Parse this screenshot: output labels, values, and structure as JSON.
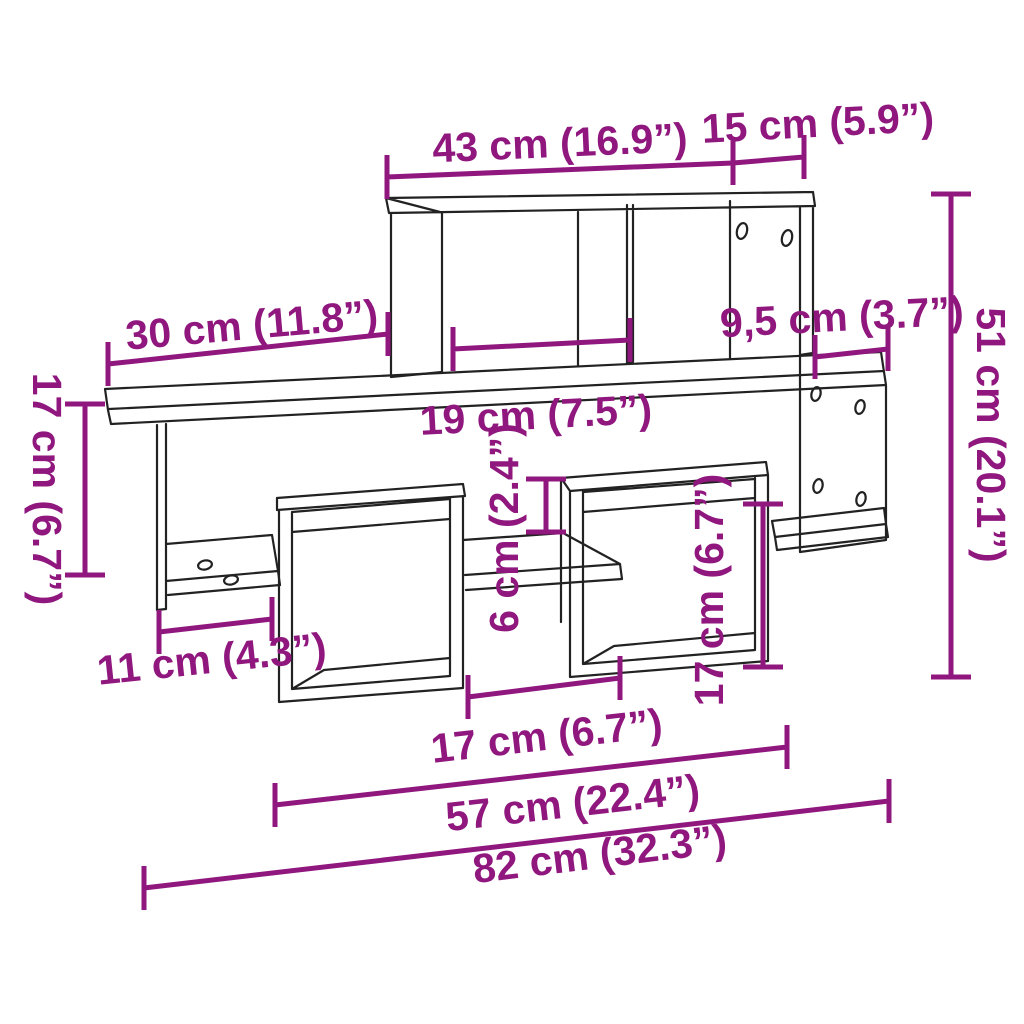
{
  "colors": {
    "dimension": "#8F177E",
    "line_art": "#222222",
    "background": "#FFFFFF"
  },
  "dimensions": {
    "top_width": {
      "label": "43 cm (16.9”)"
    },
    "top_depth": {
      "label": "15 cm (5.9”)"
    },
    "left_shelf_width": {
      "label": "30 cm (11.8”)"
    },
    "compartment_width": {
      "label": "19 cm (7.5”)"
    },
    "right_overhang": {
      "label": "9,5 cm (3.7”)"
    },
    "total_height": {
      "label": "51 cm (20.1”)"
    },
    "left_height": {
      "label": "17 cm (6.7”)"
    },
    "middle_gap_height": {
      "label": "6 cm (2.4”)"
    },
    "cube_inner_height": {
      "label": "17 cm (6.7”)"
    },
    "left_gap_width": {
      "label": "11 cm (4.3”)"
    },
    "cube_gap_width": {
      "label": "17 cm (6.7”)"
    },
    "lower_span_width": {
      "label": "57 cm (22.4”)"
    },
    "total_width": {
      "label": "82 cm (32.3”)"
    }
  }
}
